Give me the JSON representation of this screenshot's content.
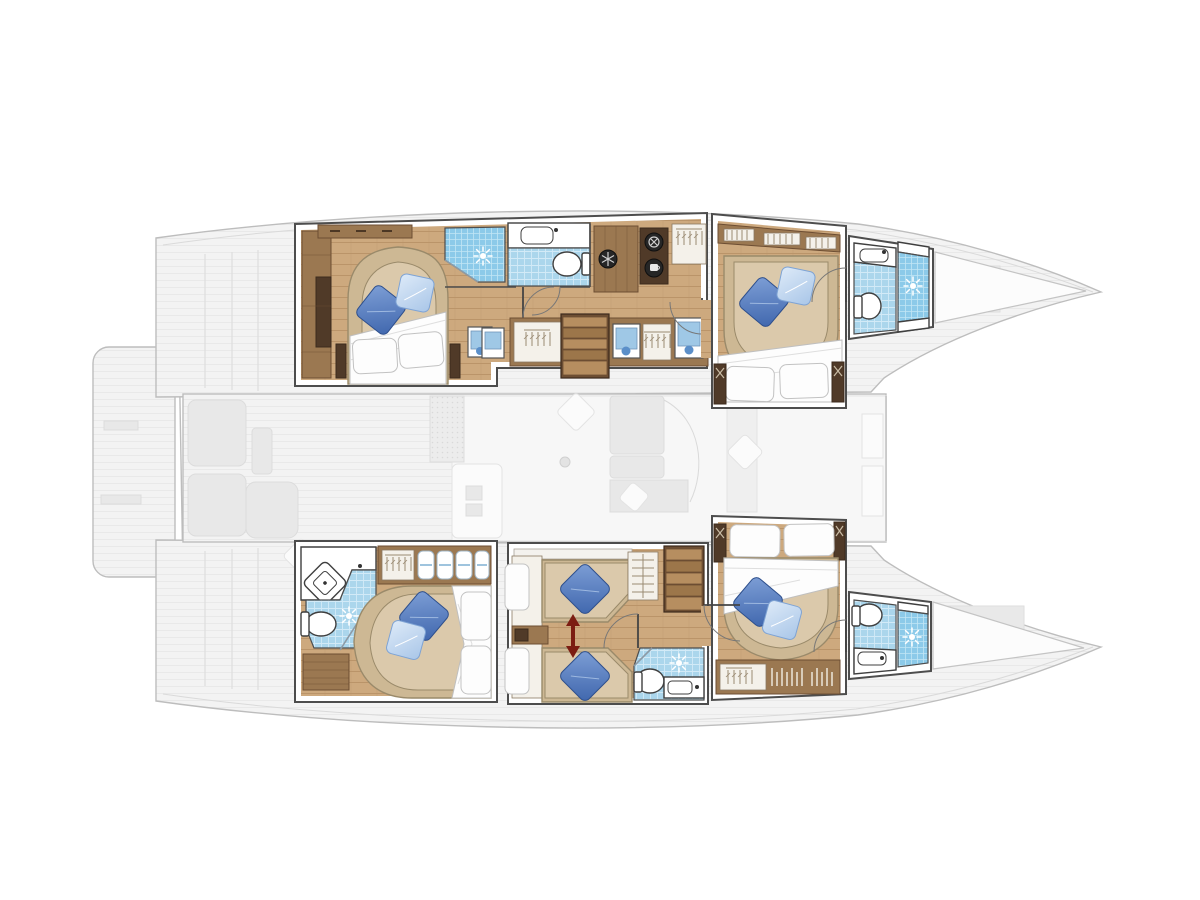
{
  "page": {
    "kind": "yacht interior floor plan",
    "vessel_type": "sailing catamaran",
    "view": "top-down deck/accommodation plan",
    "orientation": "bow pointing right, stern left",
    "visible_text": []
  },
  "palette": {
    "bg": "#ffffff",
    "ghost-fill": "#f3f3f3",
    "ghost-line": "#bdbdbd",
    "ghost-furniture": "#e8e8e8",
    "wall-line": "#4d4d4d",
    "floor-wood": "#cda97e",
    "floor-line": "#ba9469",
    "wood-mid": "#9b7851",
    "wood-dark": "#6d4e33",
    "wood-deep": "#503a28",
    "stair-light": "#b68e60",
    "stair-dark": "#9c764a",
    "bed-platform": "#cdb894",
    "mattress": "#dbc9ab",
    "mattress-line": "#9a8a6a",
    "duvet": "#fdfdfd",
    "duvet-line": "#bfbfbf",
    "pillow-dark": "#3f66ad",
    "pillow-light": "#a9c6e8",
    "tile": "#abd6ec",
    "tile-line": "#d2eaf7",
    "shower-blue": "#8ccae9",
    "shower-line": "#c2e6f5",
    "fixture-line": "#3f3f3f",
    "arrow-red": "#7c1d12",
    "hatch-blue": "#9fc8e6"
  },
  "diagram": {
    "ghost_deck": {
      "elements": [
        "swim-platform",
        "port-hull-silhouette",
        "starboard-hull-silhouette",
        "bridgedeck",
        "cockpit-seating",
        "saloon-and-galley",
        "sofa",
        "foredeck",
        "bow-trampoline-gap"
      ]
    },
    "starboard_hull_top": {
      "rooms": [
        {
          "name": "aft-cabin",
          "features": [
            "double-bed",
            "blue-throw-pillows",
            "white-duvet",
            "wardrobe",
            "shelf",
            "escape-hatch"
          ]
        },
        {
          "name": "midship-bathroom",
          "features": [
            "shower",
            "sun-drain-icon",
            "washbasin",
            "toilet"
          ]
        },
        {
          "name": "companionway",
          "features": [
            "snowflake-icon",
            "washer-icon",
            "coffee-machine-icon",
            "hanging-locker",
            "stairs",
            "lockers",
            "escape-hatches"
          ]
        },
        {
          "name": "forward-cabin",
          "features": [
            "double-bed",
            "blue-throw-pillows",
            "wardrobe-with-hangers",
            "speaker-posts"
          ]
        },
        {
          "name": "forward-bathroom",
          "features": [
            "washbasin",
            "toilet",
            "shower",
            "sun-drain-icon"
          ]
        }
      ]
    },
    "port_hull_bottom": {
      "rooms": [
        {
          "name": "aft-bathroom",
          "features": [
            "corner-washbasin",
            "shower",
            "sun-drain-icon",
            "toilet",
            "slatted-bench"
          ]
        },
        {
          "name": "aft-cabin",
          "features": [
            "double-bed",
            "blue-throw-pillows",
            "towel-shelf",
            "hanging-locker"
          ]
        },
        {
          "name": "twin-cabin",
          "features": [
            "two-single-beds",
            "blue-throw-pillows",
            "sliding-berth-red-arrow",
            "shelf",
            "hanging-locker",
            "stairs"
          ]
        },
        {
          "name": "midship-bathroom",
          "features": [
            "toilet",
            "sun-drain-icon",
            "washbasin"
          ]
        },
        {
          "name": "forward-cabin",
          "features": [
            "double-bed",
            "blue-throw-pillows",
            "wardrobe-with-hangers",
            "speaker-posts"
          ]
        },
        {
          "name": "forward-bathroom",
          "features": [
            "toilet",
            "shower",
            "sun-drain-icon",
            "washbasin"
          ]
        }
      ]
    },
    "icons": [
      "sun-drain-icon",
      "snowflake-icon",
      "washer-icon",
      "coffee-machine-icon",
      "hanger-icon",
      "double-arrow-icon"
    ]
  }
}
